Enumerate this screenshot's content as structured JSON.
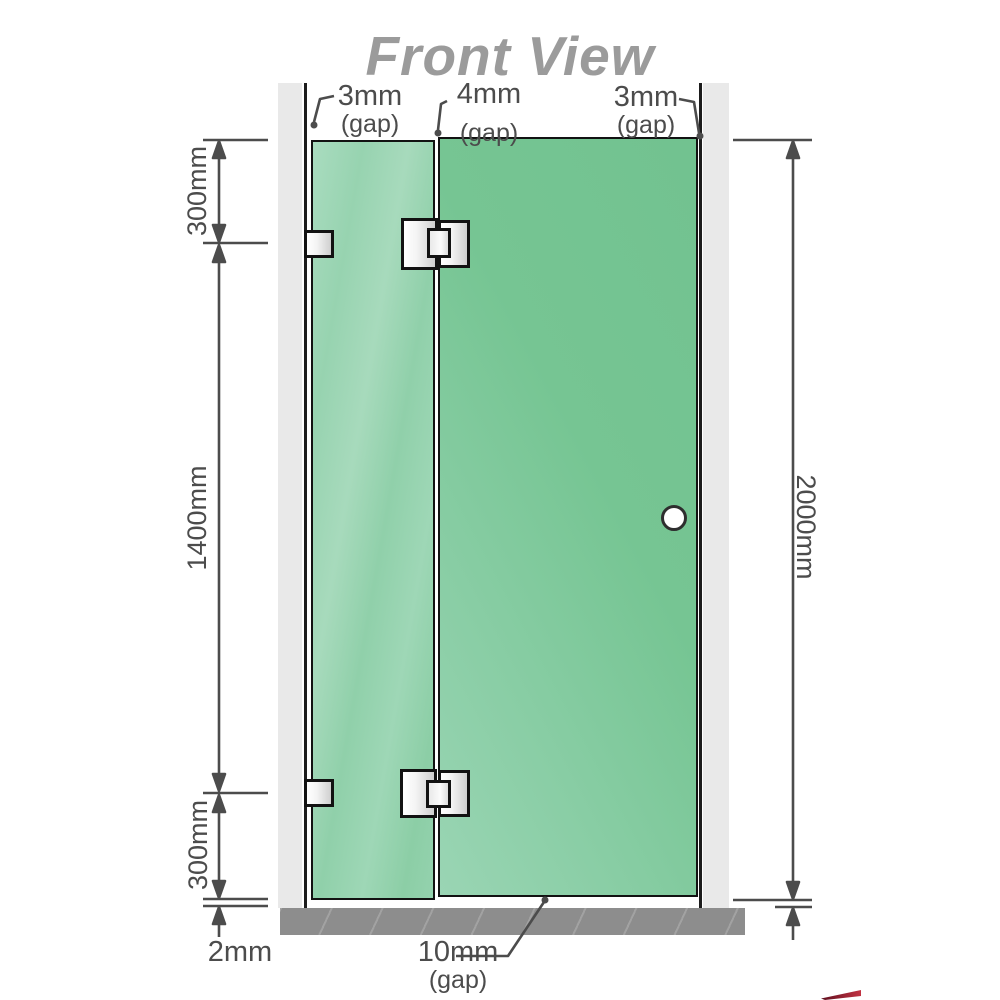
{
  "title": "Front View",
  "dimensions": {
    "left_top": "300mm",
    "left_middle": "1400mm",
    "left_bottom": "300mm",
    "floor_gap": "2mm",
    "right_total": "2000mm"
  },
  "gaps": {
    "left": {
      "value": "3mm",
      "note": "(gap)"
    },
    "middle": {
      "value": "4mm",
      "note": "(gap)"
    },
    "right": {
      "value": "3mm",
      "note": "(gap)"
    },
    "bottom": {
      "value": "10mm",
      "note": "(gap)"
    }
  },
  "colors": {
    "glass_green": "#7cc89a",
    "glass_green_light": "#a7dabc",
    "wall_gray": "#e9e9e9",
    "floor_gray": "#8d8d8d",
    "dimension_gray": "#4c4c4c",
    "title_gray": "#9b9b9b",
    "hinge_metal": "#e8e8e8"
  }
}
